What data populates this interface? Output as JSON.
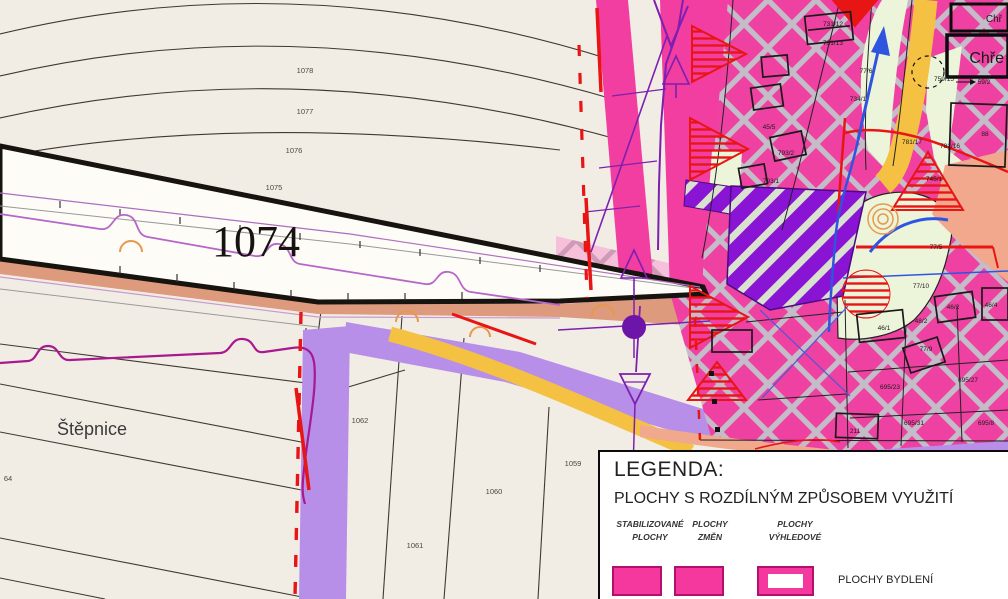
{
  "map": {
    "road_label": "1074",
    "area_label": "Štěpnice",
    "street_box_small": "Chř",
    "street_box_large": "Chře",
    "parcel_labels": [
      {
        "text": "1078",
        "x": 305,
        "y": 73,
        "cls": "g"
      },
      {
        "text": "1077",
        "x": 305,
        "y": 114,
        "cls": "g"
      },
      {
        "text": "1076",
        "x": 294,
        "y": 153,
        "cls": "g"
      },
      {
        "text": "1075",
        "x": 274,
        "y": 190,
        "cls": "g"
      },
      {
        "text": "1062",
        "x": 360,
        "y": 423,
        "cls": "g"
      },
      {
        "text": "1059",
        "x": 573,
        "y": 466,
        "cls": "g"
      },
      {
        "text": "1060",
        "x": 494,
        "y": 494,
        "cls": "g"
      },
      {
        "text": "1061",
        "x": 415,
        "y": 548,
        "cls": "g"
      },
      {
        "text": "64",
        "x": 8,
        "y": 481,
        "cls": "g"
      },
      {
        "text": "731/12",
        "x": 833,
        "y": 26
      },
      {
        "text": "731/13",
        "x": 833,
        "y": 45
      },
      {
        "text": "45/5",
        "x": 769,
        "y": 129
      },
      {
        "text": "77/6",
        "x": 866,
        "y": 73
      },
      {
        "text": "734/1",
        "x": 858,
        "y": 101
      },
      {
        "text": "793/2",
        "x": 786,
        "y": 155
      },
      {
        "text": "793/1",
        "x": 771,
        "y": 183
      },
      {
        "text": "759/15",
        "x": 944,
        "y": 81
      },
      {
        "text": "59/2",
        "x": 984,
        "y": 84
      },
      {
        "text": "88",
        "x": 985,
        "y": 136
      },
      {
        "text": "781/17",
        "x": 912,
        "y": 144
      },
      {
        "text": "781/16",
        "x": 950,
        "y": 148
      },
      {
        "text": "745/1",
        "x": 934,
        "y": 181
      },
      {
        "text": "77/5",
        "x": 936,
        "y": 249
      },
      {
        "text": "77/10",
        "x": 921,
        "y": 288
      },
      {
        "text": "46/1",
        "x": 884,
        "y": 330
      },
      {
        "text": "48/2",
        "x": 921,
        "y": 323
      },
      {
        "text": "46/2",
        "x": 953,
        "y": 309
      },
      {
        "text": "46/4",
        "x": 991,
        "y": 307
      },
      {
        "text": "77/9",
        "x": 926,
        "y": 351
      },
      {
        "text": "695/23",
        "x": 890,
        "y": 389
      },
      {
        "text": "695/27",
        "x": 968,
        "y": 382
      },
      {
        "text": "695/31",
        "x": 914,
        "y": 425
      },
      {
        "text": "695/8",
        "x": 986,
        "y": 425
      },
      {
        "text": "211",
        "x": 855,
        "y": 433
      }
    ]
  },
  "legend": {
    "title": "LEGENDA:",
    "subtitle": "PLOCHY S ROZDÍLNÝM ZPŮSOBEM VYUŽITÍ",
    "col1_line1": "STABILIZOVANÉ",
    "col1_line2": "PLOCHY",
    "col2_line1": "PLOCHY",
    "col2_line2": "ZMĚN",
    "col3_line1": "PLOCHY",
    "col3_line2": "VÝHLEDOVÉ",
    "item_label": "PLOCHY BYDLENÍ"
  },
  "colors": {
    "pink": "#f23da1",
    "lavender": "#b78fe9",
    "yellow": "#f4c143",
    "salmon": "#dd9a7d",
    "coral": "#f2a88d",
    "green": "#ecf5da",
    "purple": "#8a14d4",
    "red": "#e81515",
    "blue": "#2f55e0",
    "cream": "#f2ede4"
  }
}
